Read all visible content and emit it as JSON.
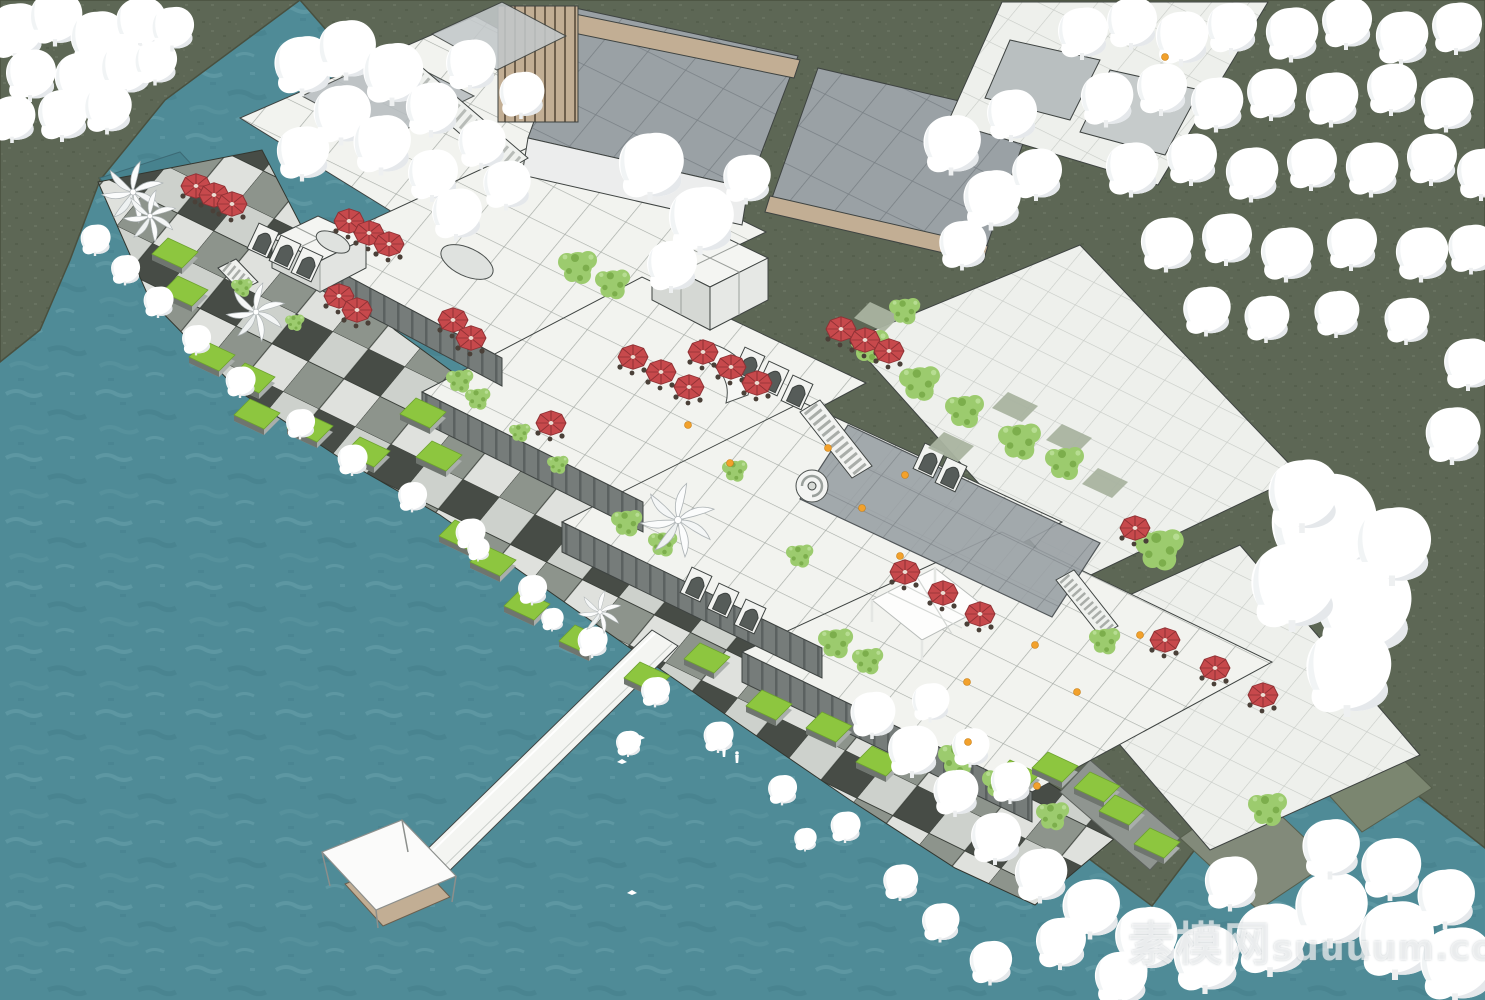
{
  "watermark": {
    "text_cn": "素模网",
    "text_en": "suuuum.com"
  },
  "colors": {
    "water": "#4f8b97",
    "water_deep": "#47828e",
    "land": "#5d6755",
    "slope": "#7b8670",
    "tile": "#f2f3ef",
    "glass": "#9aa1a5",
    "wood": "#c2ae94",
    "lawn": "#8dc63f",
    "red": "#c7494c",
    "tree": "#9ccb6e",
    "blob": "#ffffff",
    "wm": "rgba(255,255,255,0.62)"
  },
  "scene": {
    "umbrellas": [
      [
        196,
        186
      ],
      [
        214,
        195
      ],
      [
        232,
        204
      ],
      [
        349,
        221
      ],
      [
        369,
        233
      ],
      [
        389,
        244
      ],
      [
        339,
        296
      ],
      [
        357,
        310
      ],
      [
        453,
        320
      ],
      [
        471,
        338
      ],
      [
        551,
        423
      ],
      [
        633,
        357
      ],
      [
        661,
        372
      ],
      [
        689,
        387
      ],
      [
        703,
        352
      ],
      [
        731,
        367
      ],
      [
        757,
        383
      ],
      [
        841,
        329
      ],
      [
        865,
        340
      ],
      [
        889,
        351
      ],
      [
        905,
        572
      ],
      [
        943,
        593
      ],
      [
        980,
        614
      ],
      [
        1135,
        528
      ],
      [
        1165,
        640
      ],
      [
        1215,
        668
      ],
      [
        1263,
        695
      ]
    ],
    "lawns": [
      [
        168,
        238
      ],
      [
        178,
        276
      ],
      [
        205,
        341
      ],
      [
        245,
        363
      ],
      [
        250,
        399
      ],
      [
        303,
        412
      ],
      [
        360,
        437
      ],
      [
        416,
        398
      ],
      [
        432,
        441
      ],
      [
        455,
        520
      ],
      [
        486,
        546
      ],
      [
        520,
        590
      ],
      [
        575,
        625
      ],
      [
        640,
        662
      ],
      [
        700,
        643
      ],
      [
        762,
        690
      ],
      [
        822,
        712
      ],
      [
        872,
        746
      ],
      [
        1010,
        760
      ],
      [
        1048,
        752
      ],
      [
        1090,
        772
      ],
      [
        1115,
        795
      ],
      [
        1150,
        828
      ]
    ],
    "sage": [
      [
        1008,
        392
      ],
      [
        1062,
        424
      ],
      [
        944,
        432
      ],
      [
        1098,
        468
      ],
      [
        870,
        302
      ]
    ],
    "trees": [
      [
        578,
        266,
        1
      ],
      [
        613,
        283,
        0.9
      ],
      [
        870,
        345,
        1
      ],
      [
        920,
        382,
        1.05
      ],
      [
        965,
        410,
        1
      ],
      [
        1020,
        440,
        1.1
      ],
      [
        1065,
        462,
        1
      ],
      [
        460,
        380,
        0.7
      ],
      [
        478,
        398,
        0.65
      ],
      [
        627,
        522,
        0.8
      ],
      [
        663,
        543,
        0.75
      ],
      [
        836,
        642,
        0.9
      ],
      [
        868,
        660,
        0.8
      ],
      [
        958,
        758,
        1
      ],
      [
        1000,
        782,
        0.9
      ],
      [
        1160,
        548,
        1.25
      ],
      [
        1268,
        808,
        1
      ],
      [
        1053,
        815,
        0.85
      ],
      [
        735,
        470,
        0.65
      ],
      [
        800,
        555,
        0.7
      ],
      [
        905,
        310,
        0.8
      ],
      [
        242,
        287,
        0.55
      ],
      [
        295,
        322,
        0.5
      ],
      [
        520,
        432,
        0.55
      ],
      [
        558,
        464,
        0.55
      ],
      [
        1105,
        640,
        0.8
      ]
    ],
    "palms": [
      [
        133,
        192,
        1
      ],
      [
        150,
        216,
        0.85
      ],
      [
        256,
        312,
        0.95
      ],
      [
        678,
        520,
        1.2
      ],
      [
        600,
        612,
        0.7
      ]
    ],
    "blobs": [
      [
        15,
        28,
        1.1
      ],
      [
        55,
        15,
        1.05
      ],
      [
        97,
        36,
        1.1
      ],
      [
        140,
        20,
        1
      ],
      [
        30,
        72,
        1
      ],
      [
        80,
        76,
        1.05
      ],
      [
        125,
        66,
        1
      ],
      [
        12,
        116,
        0.9
      ],
      [
        62,
        112,
        1
      ],
      [
        107,
        106,
        0.95
      ],
      [
        155,
        60,
        0.85
      ],
      [
        172,
        26,
        0.85
      ],
      [
        302,
        62,
        1.15
      ],
      [
        346,
        46,
        1.15
      ],
      [
        392,
        70,
        1.2
      ],
      [
        341,
        111,
        1.15
      ],
      [
        302,
        150,
        1.05
      ],
      [
        381,
        141,
        1.15
      ],
      [
        431,
        106,
        1.05
      ],
      [
        470,
        62,
        1
      ],
      [
        432,
        172,
        1
      ],
      [
        481,
        141,
        0.95
      ],
      [
        521,
        92,
        0.9
      ],
      [
        456,
        211,
        1
      ],
      [
        506,
        182,
        0.95
      ],
      [
        650,
        162,
        1.3
      ],
      [
        700,
        216,
        1.3
      ],
      [
        671,
        263,
        1
      ],
      [
        746,
        176,
        0.95
      ],
      [
        951,
        141,
        1.15
      ],
      [
        991,
        196,
        1.15
      ],
      [
        1011,
        112,
        1
      ],
      [
        1036,
        171,
        1
      ],
      [
        962,
        242,
        0.95
      ],
      [
        1082,
        30,
        1
      ],
      [
        1131,
        20,
        1
      ],
      [
        1181,
        35,
        1.05
      ],
      [
        1231,
        25,
        1
      ],
      [
        1291,
        31,
        1.05
      ],
      [
        1346,
        20,
        1
      ],
      [
        1401,
        35,
        1.05
      ],
      [
        1456,
        25,
        1
      ],
      [
        1106,
        96,
        1.05
      ],
      [
        1161,
        86,
        1
      ],
      [
        1216,
        101,
        1.05
      ],
      [
        1271,
        91,
        1
      ],
      [
        1331,
        96,
        1.05
      ],
      [
        1391,
        86,
        1
      ],
      [
        1446,
        101,
        1.05
      ],
      [
        1131,
        166,
        1.05
      ],
      [
        1191,
        156,
        1
      ],
      [
        1251,
        171,
        1.05
      ],
      [
        1311,
        161,
        1
      ],
      [
        1371,
        166,
        1.05
      ],
      [
        1431,
        156,
        1
      ],
      [
        1481,
        171,
        1
      ],
      [
        1166,
        241,
        1.05
      ],
      [
        1226,
        236,
        1
      ],
      [
        1286,
        251,
        1.05
      ],
      [
        1351,
        241,
        1
      ],
      [
        1421,
        251,
        1.05
      ],
      [
        1471,
        246,
        0.95
      ],
      [
        1206,
        308,
        0.95
      ],
      [
        1266,
        316,
        0.9
      ],
      [
        1336,
        311,
        0.9
      ],
      [
        1406,
        318,
        0.9
      ],
      [
        1322,
        521,
        2.1
      ],
      [
        1362,
        601,
        1.9
      ],
      [
        1292,
        581,
        1.7
      ],
      [
        1347,
        666,
        1.7
      ],
      [
        1392,
        541,
        1.5
      ],
      [
        1302,
        491,
        1.4
      ],
      [
        1452,
        432,
        1.1
      ],
      [
        1468,
        361,
        1
      ],
      [
        95,
        238,
        0.6
      ],
      [
        125,
        268,
        0.58
      ],
      [
        158,
        300,
        0.6
      ],
      [
        196,
        338,
        0.58
      ],
      [
        240,
        380,
        0.6
      ],
      [
        300,
        422,
        0.58
      ],
      [
        352,
        458,
        0.6
      ],
      [
        412,
        495,
        0.58
      ],
      [
        470,
        532,
        0.6
      ],
      [
        532,
        588,
        0.58
      ],
      [
        592,
        640,
        0.6
      ],
      [
        655,
        690,
        0.58
      ],
      [
        718,
        735,
        0.6
      ],
      [
        782,
        788,
        0.58
      ],
      [
        845,
        825,
        0.6
      ],
      [
        478,
        548,
        0.45
      ],
      [
        552,
        618,
        0.45
      ],
      [
        628,
        742,
        0.5
      ],
      [
        805,
        838,
        0.45
      ],
      [
        872,
        712,
        0.9
      ],
      [
        912,
        748,
        1
      ],
      [
        955,
        790,
        0.9
      ],
      [
        995,
        835,
        1
      ],
      [
        1040,
        872,
        1.05
      ],
      [
        1090,
        905,
        1.15
      ],
      [
        1145,
        935,
        1.25
      ],
      [
        1205,
        955,
        1.3
      ],
      [
        1270,
        935,
        1.4
      ],
      [
        1330,
        905,
        1.45
      ],
      [
        1395,
        935,
        1.5
      ],
      [
        1455,
        960,
        1.45
      ],
      [
        1330,
        845,
        1.15
      ],
      [
        1390,
        865,
        1.2
      ],
      [
        1445,
        895,
        1.15
      ],
      [
        1230,
        880,
        1.05
      ],
      [
        970,
        745,
        0.75
      ],
      [
        1010,
        780,
        0.8
      ],
      [
        930,
        700,
        0.75
      ],
      [
        1060,
        940,
        1
      ],
      [
        1120,
        975,
        1.05
      ],
      [
        990,
        960,
        0.85
      ],
      [
        940,
        920,
        0.75
      ],
      [
        900,
        880,
        0.7
      ]
    ],
    "lights": [
      [
        688,
        425
      ],
      [
        828,
        448
      ],
      [
        862,
        508
      ],
      [
        900,
        556
      ],
      [
        1035,
        645
      ],
      [
        967,
        682
      ],
      [
        1077,
        692
      ],
      [
        1140,
        635
      ],
      [
        1037,
        786
      ],
      [
        905,
        475
      ],
      [
        730,
        463
      ],
      [
        968,
        742
      ],
      [
        1165,
        57
      ]
    ],
    "boats": [
      [
        640,
        738
      ],
      [
        622,
        762
      ],
      [
        808,
        838
      ],
      [
        632,
        893
      ]
    ],
    "people": [
      [
        724,
        752
      ],
      [
        737,
        758
      ]
    ]
  }
}
